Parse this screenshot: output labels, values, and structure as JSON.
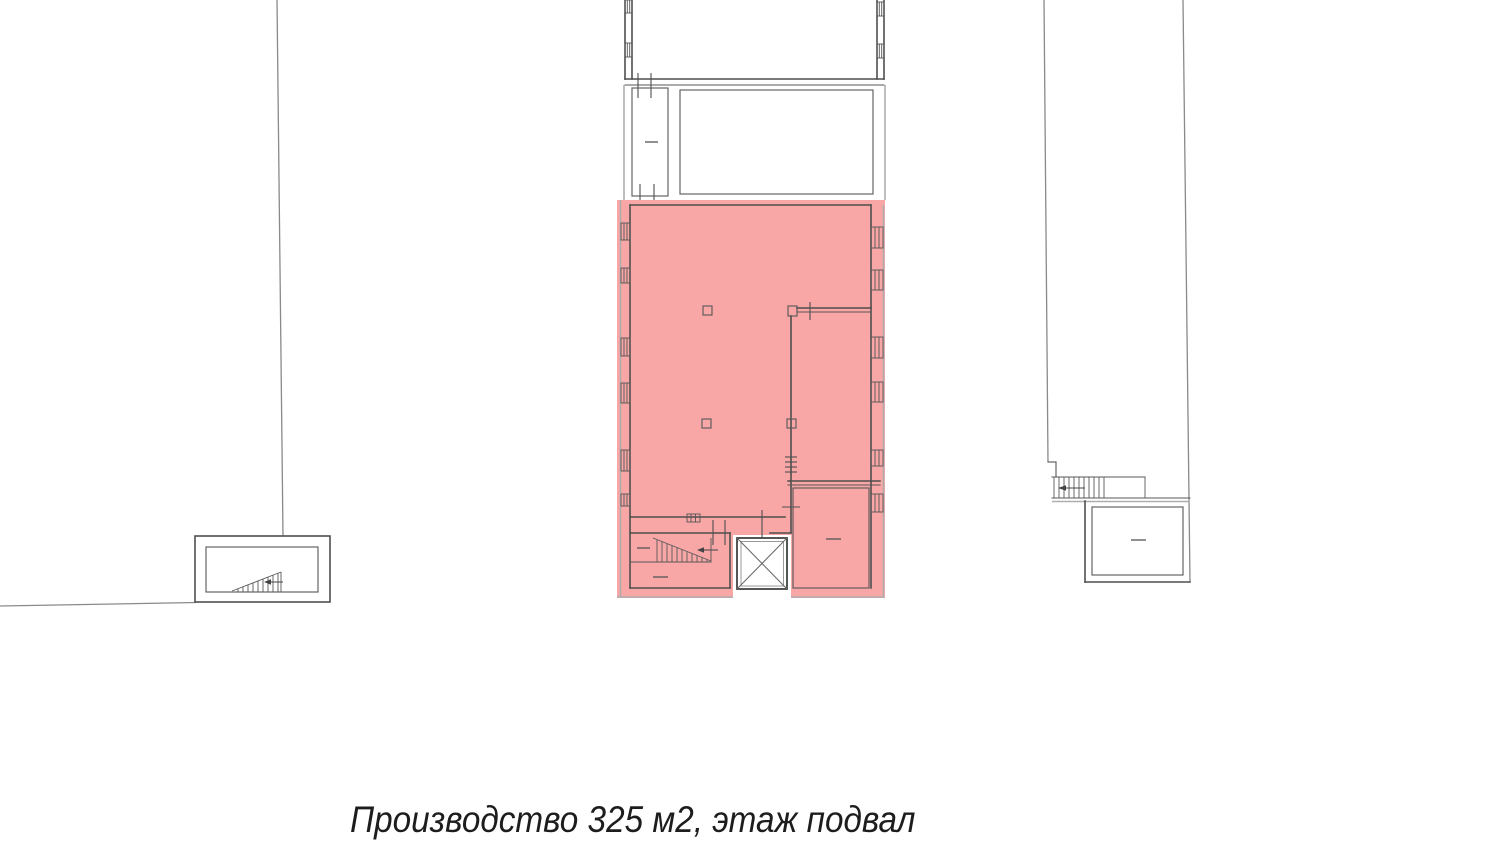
{
  "caption": {
    "text": "Производство 325 м2, этаж подвал",
    "area_label": "Производство",
    "area_value": "325 м2",
    "floor_label": "этаж подвал"
  },
  "colors": {
    "highlight": "#f8a6a6",
    "highlight_edge": "#de9090",
    "wall": "#4f4f4f",
    "secondary_line": "#aeaeae",
    "text": "#1d1d1d",
    "background": "#ffffff"
  }
}
